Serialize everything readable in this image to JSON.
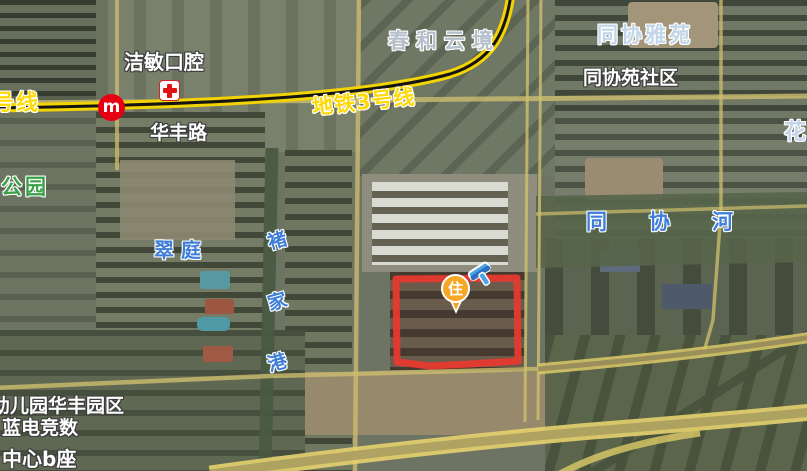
{
  "map": {
    "view_type": "satellite",
    "road_labels": {
      "line_left_partial": "号线",
      "metro_line3": "地铁3号线",
      "huafeng_road": "华丰路"
    },
    "poi_labels": {
      "jiemin_dental": "洁敏口腔",
      "chunhe_yunjing": "春和云境",
      "tongxie_yayuan": "同协雅苑",
      "tongxieyuan_community": "同协苑社区",
      "hua_partial": "花",
      "park": "公园",
      "cuiting": "翠庭",
      "kindergarten_huafeng": "幼儿园华丰园区",
      "landian_esports": "蓝电竞数",
      "center_b_block": "中心b座"
    },
    "water_labels": {
      "chujiagang": [
        "褚",
        "家",
        "港"
      ],
      "tongxie_river": [
        "同",
        "协",
        "河"
      ]
    },
    "marker": {
      "label": "住"
    },
    "metro_station": {
      "logo_letter": "m"
    },
    "colors": {
      "metro_line_yellow": "#f2d303",
      "road_label_yellow": "#ffd903",
      "water_label_blue": "#3e7ed8",
      "park_label_green": "#39a048",
      "highlight_rect_red": "#e6392e",
      "marker_orange": "#f7a723",
      "station_red": "#e60012",
      "gavel_blue": "#4da3e8"
    }
  }
}
